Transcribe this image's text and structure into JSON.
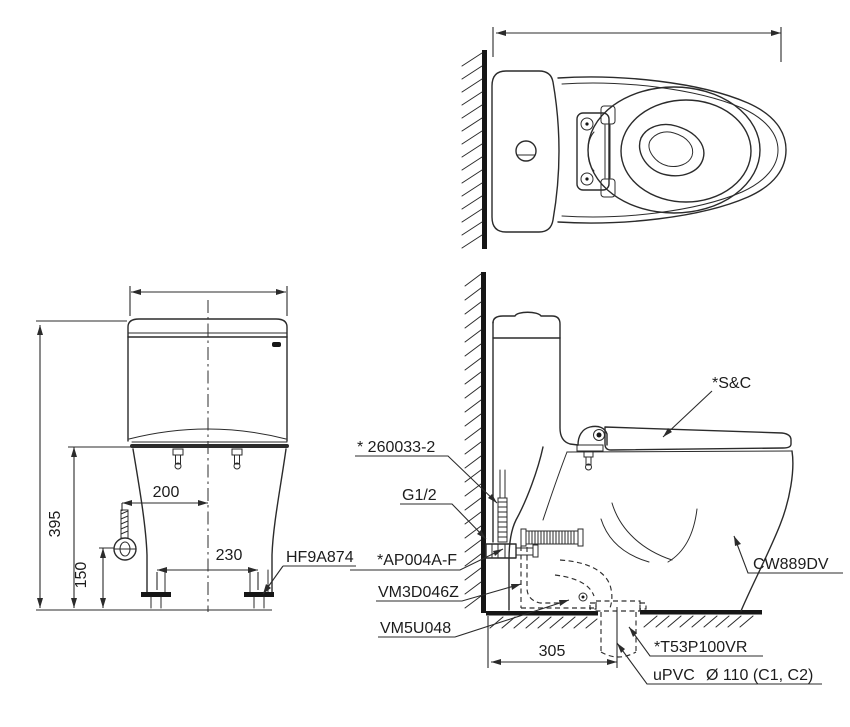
{
  "drawing": {
    "kind": "toilet installation technical drawing",
    "colors": {
      "line": "#2b2b2b",
      "heavy": "#161616",
      "background": "#ffffff"
    }
  },
  "front_view": {
    "dim_height_rim": "395",
    "dim_valve_height": "150",
    "dim_valve_offset": "200",
    "dim_bolt_spacing": "230",
    "label_bolt_cap": "HF9A874"
  },
  "side_view": {
    "label_seat_cover": "*S&C",
    "label_hose": "* 260033-2",
    "label_supply_thread": "G1/2",
    "label_stop_valve": "*AP004A-F",
    "label_seal": "VM3D046Z",
    "label_flange": "VM5U048",
    "label_bowl_model": "CW889DV",
    "label_drain_joint": "*T53P100VR",
    "label_pipe_material": "uPVC",
    "label_pipe_size": "Ø 110 (C1, C2)",
    "dim_rough_in": "305"
  }
}
